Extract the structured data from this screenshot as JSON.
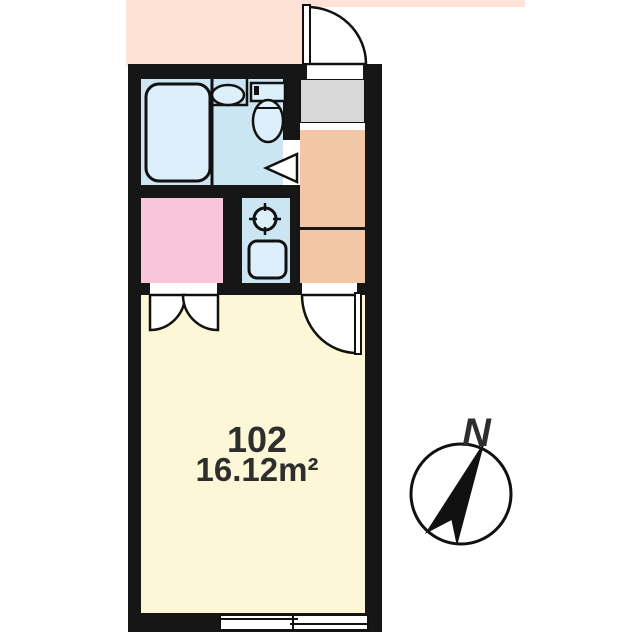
{
  "plan": {
    "room_number": "102",
    "room_area": "16.12m²"
  },
  "compass": {
    "north_label": "N"
  },
  "colors": {
    "wall": "#161616",
    "exterior_peach": "#fce3d6",
    "hallway_salmon": "#f3c6a5",
    "genkan_gray": "#d8d8d8",
    "bathroom_blue": "#cbe5f3",
    "fixture_blue": "#ddeffa",
    "closet_pink": "#f8c6d8",
    "room_yellow": "#fbf7d7",
    "door_white": "#ffffff",
    "line_black": "#111111",
    "text_dark": "#2e2e2e"
  }
}
